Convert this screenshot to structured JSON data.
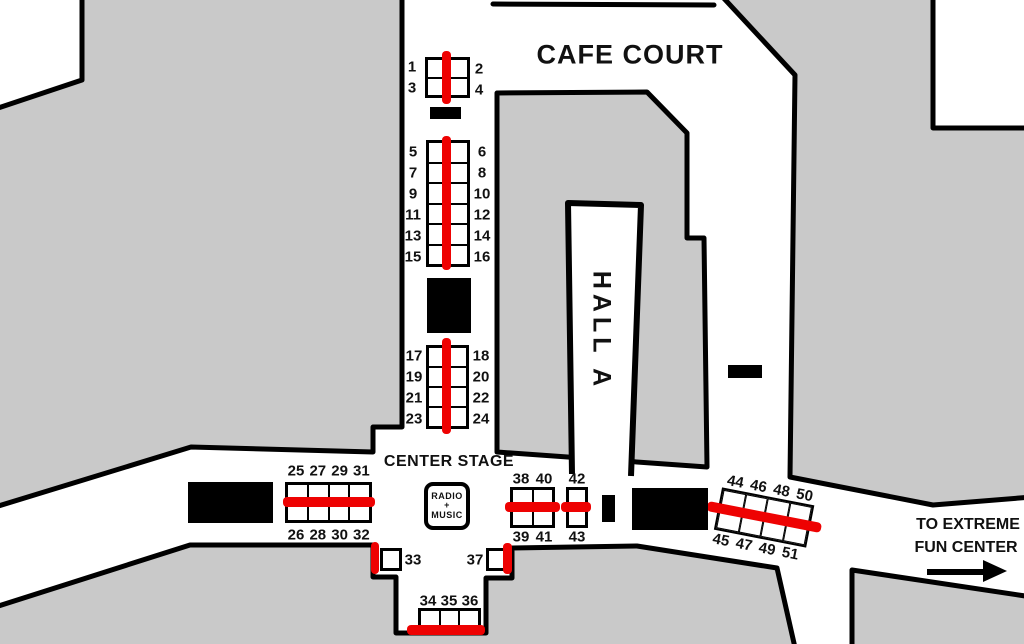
{
  "texts": {
    "cafe_court": "CAFE COURT",
    "hall_a": "HALL A",
    "center_stage": "CENTER STAGE",
    "radio_line1": "RADIO",
    "radio_line2": "+",
    "radio_line3": "MUSIC",
    "extreme_line1": "TO EXTREME",
    "extreme_line2": "FUN CENTER"
  },
  "colors": {
    "area_gray": "#c9c9c9",
    "aisle_red": "#ee0202",
    "wall_black": "#000000"
  },
  "black_blocks": [
    {
      "name": "black-bar-north",
      "x": 430,
      "y": 107,
      "w": 31,
      "h": 12
    },
    {
      "name": "black-block-mid",
      "x": 427,
      "y": 278,
      "w": 44,
      "h": 55
    },
    {
      "name": "black-block-west",
      "x": 188,
      "y": 482,
      "w": 85,
      "h": 41
    },
    {
      "name": "black-bar-hall-east",
      "x": 728,
      "y": 365,
      "w": 34,
      "h": 13
    },
    {
      "name": "black-bar-center-small",
      "x": 602,
      "y": 495,
      "w": 13,
      "h": 27
    },
    {
      "name": "black-block-east",
      "x": 632,
      "y": 488,
      "w": 76,
      "h": 42
    }
  ],
  "booth_grids": [
    {
      "name": "booth-grid-1-4",
      "x": 425,
      "y": 57,
      "w": 45,
      "h": 41,
      "cols": 2,
      "rows": 2
    },
    {
      "name": "booth-grid-5-16",
      "x": 426,
      "y": 140,
      "w": 44,
      "h": 127,
      "cols": 2,
      "rows": 6
    },
    {
      "name": "booth-grid-17-24",
      "x": 426,
      "y": 345,
      "w": 43,
      "h": 84,
      "cols": 2,
      "rows": 4
    },
    {
      "name": "booth-grid-25-32",
      "x": 285,
      "y": 482,
      "w": 87,
      "h": 41,
      "cols": 4,
      "rows": 2
    },
    {
      "name": "booth-grid-38-41",
      "x": 510,
      "y": 487,
      "w": 45,
      "h": 41,
      "cols": 2,
      "rows": 2
    },
    {
      "name": "booth-grid-42-43",
      "x": 566,
      "y": 487,
      "w": 22,
      "h": 41,
      "cols": 1,
      "rows": 2
    },
    {
      "name": "booth-grid-44-51",
      "container": "rot-4451",
      "x": 7,
      "y": 14,
      "w": 94,
      "h": 43,
      "cols": 4,
      "rows": 2
    },
    {
      "name": "booth-33",
      "x": 380,
      "y": 548,
      "w": 22,
      "h": 23,
      "cols": 1,
      "rows": 1
    },
    {
      "name": "booth-37",
      "x": 486,
      "y": 548,
      "w": 22,
      "h": 23,
      "cols": 1,
      "rows": 1
    },
    {
      "name": "booth-grid-34-36",
      "x": 418,
      "y": 608,
      "w": 63,
      "h": 22,
      "cols": 3,
      "rows": 1
    }
  ],
  "red_bands": [
    {
      "name": "red-line-1-4",
      "x": 442,
      "y": 51,
      "w": 9,
      "h": 53
    },
    {
      "name": "red-line-5-16",
      "x": 442,
      "y": 136,
      "w": 9,
      "h": 134
    },
    {
      "name": "red-line-17-24",
      "x": 442,
      "y": 338,
      "w": 9,
      "h": 96
    },
    {
      "name": "red-line-25-32",
      "x": 283,
      "y": 497,
      "w": 92,
      "h": 10
    },
    {
      "name": "red-line-38-41",
      "x": 505,
      "y": 502,
      "w": 55,
      "h": 10
    },
    {
      "name": "red-line-42-43",
      "x": 561,
      "y": 502,
      "w": 30,
      "h": 10
    },
    {
      "name": "red-line-44-51",
      "container": "rot-4451",
      "x": -4,
      "y": 30,
      "w": 116,
      "h": 10
    },
    {
      "name": "red-line-33",
      "x": 371,
      "y": 542,
      "w": 8,
      "h": 32
    },
    {
      "name": "red-line-37",
      "x": 503,
      "y": 543,
      "w": 9,
      "h": 31
    },
    {
      "name": "red-line-34-36",
      "x": 407,
      "y": 625,
      "w": 78,
      "h": 10
    }
  ],
  "booth_labels": [
    {
      "name": "labels-1-3",
      "items": [
        "1",
        "3"
      ],
      "x": 412,
      "y": 67,
      "dx": 0,
      "dy": 21
    },
    {
      "name": "labels-2-4",
      "items": [
        "2",
        "4"
      ],
      "x": 479,
      "y": 69,
      "dx": 0,
      "dy": 21
    },
    {
      "name": "labels-5-15",
      "items": [
        "5",
        "7",
        "9",
        "11",
        "13",
        "15"
      ],
      "x": 413,
      "y": 152,
      "dx": 0,
      "dy": 21
    },
    {
      "name": "labels-6-16",
      "items": [
        "6",
        "8",
        "10",
        "12",
        "14",
        "16"
      ],
      "x": 482,
      "y": 152,
      "dx": 0,
      "dy": 21
    },
    {
      "name": "labels-17-23",
      "items": [
        "17",
        "19",
        "21",
        "23"
      ],
      "x": 414,
      "y": 356,
      "dx": 0,
      "dy": 21
    },
    {
      "name": "labels-18-24",
      "items": [
        "18",
        "20",
        "22",
        "24"
      ],
      "x": 481,
      "y": 356,
      "dx": 0,
      "dy": 21
    },
    {
      "name": "labels-25-31",
      "items": [
        "25",
        "27",
        "29",
        "31"
      ],
      "x": 296,
      "y": 471,
      "dx": 21.8,
      "dy": 0
    },
    {
      "name": "labels-26-32",
      "items": [
        "26",
        "28",
        "30",
        "32"
      ],
      "x": 296,
      "y": 535,
      "dx": 21.8,
      "dy": 0
    },
    {
      "name": "labels-38-40",
      "items": [
        "38",
        "40"
      ],
      "x": 521,
      "y": 479,
      "dx": 23,
      "dy": 0
    },
    {
      "name": "labels-39-41",
      "items": [
        "39",
        "41"
      ],
      "x": 521,
      "y": 537,
      "dx": 23,
      "dy": 0
    },
    {
      "name": "label-42",
      "items": [
        "42"
      ],
      "x": 577,
      "y": 479,
      "dx": 0,
      "dy": 0
    },
    {
      "name": "label-43",
      "items": [
        "43"
      ],
      "x": 577,
      "y": 537,
      "dx": 0,
      "dy": 0
    },
    {
      "name": "label-33",
      "items": [
        "33"
      ],
      "x": 413,
      "y": 560,
      "dx": 0,
      "dy": 0
    },
    {
      "name": "label-37",
      "items": [
        "37"
      ],
      "x": 475,
      "y": 560,
      "dx": 0,
      "dy": 0
    },
    {
      "name": "labels-34-36",
      "items": [
        "34",
        "35",
        "36"
      ],
      "x": 428,
      "y": 601,
      "dx": 21,
      "dy": 0
    },
    {
      "name": "labels-44-50",
      "container": "rot-4451",
      "items": [
        "44",
        "46",
        "48",
        "50"
      ],
      "x": 19,
      "y": 6,
      "dx": 23.5,
      "dy": 0
    },
    {
      "name": "labels-45-51",
      "container": "rot-4451",
      "items": [
        "45",
        "47",
        "49",
        "51"
      ],
      "x": 16,
      "y": 66,
      "dx": 23.5,
      "dy": 0
    }
  ]
}
